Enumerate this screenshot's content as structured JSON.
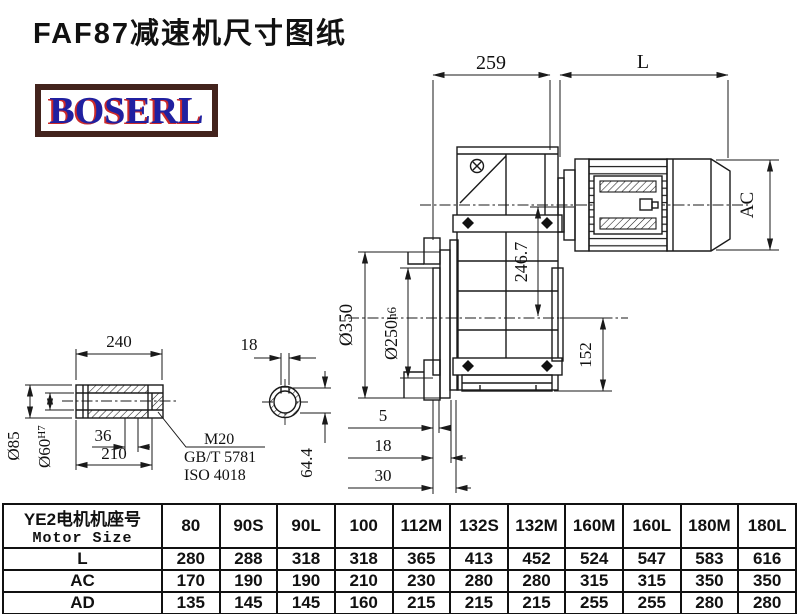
{
  "title": "FAF87减速机尺寸图纸",
  "logo": {
    "text": "BOSERL"
  },
  "colors": {
    "line": "#1a1a1a",
    "background": "#ffffff",
    "logo_border": "#43231d",
    "logo_text": "#2020a0",
    "logo_shadow": "#cc2a2a"
  },
  "drawing": {
    "main_view": {
      "dim_259": "259",
      "dim_L": "L",
      "dim_AC": "AC",
      "dim_246_7": "246.7",
      "dim_o350": "Ø350",
      "dim_o250": "Ø250",
      "dim_o250_tol": "h6",
      "dim_152": "152",
      "dim_5": "5",
      "dim_18": "18",
      "dim_30": "30"
    },
    "shaft_view": {
      "dim_240": "240",
      "dim_210": "210",
      "dim_36": "36",
      "dim_o85": "Ø85",
      "dim_o60": "Ø60",
      "dim_o60_tol": "H7",
      "thread": "M20",
      "thread_std_gb": "GB/T 5781",
      "thread_std_iso": "ISO 4018"
    },
    "section_view": {
      "dim_18": "18",
      "dim_64_4": "64.4"
    }
  },
  "table": {
    "header": {
      "line1": "YE2电机机座号",
      "line2": "Motor Size"
    },
    "columns": [
      "80",
      "90S",
      "90L",
      "100",
      "112M",
      "132S",
      "132M",
      "160M",
      "160L",
      "180M",
      "180L"
    ],
    "rows": [
      {
        "label": "L",
        "values": [
          "280",
          "288",
          "318",
          "318",
          "365",
          "413",
          "452",
          "524",
          "547",
          "583",
          "616"
        ]
      },
      {
        "label": "AC",
        "values": [
          "170",
          "190",
          "190",
          "210",
          "230",
          "280",
          "280",
          "315",
          "315",
          "350",
          "350"
        ]
      },
      {
        "label": "AD",
        "values": [
          "135",
          "145",
          "145",
          "160",
          "215",
          "215",
          "215",
          "255",
          "255",
          "280",
          "280"
        ]
      }
    ]
  }
}
